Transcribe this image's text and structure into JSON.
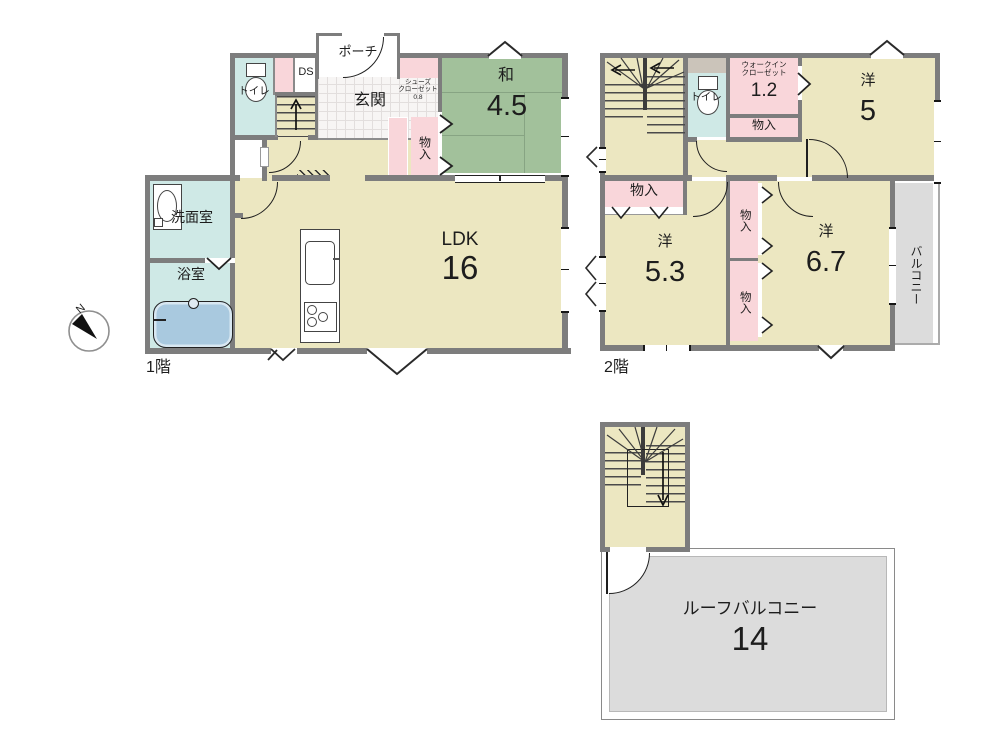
{
  "compass": {
    "north": "N"
  },
  "shared": {
    "storage": "物入",
    "toilet": "トイレ",
    "western": "洋"
  },
  "floor1": {
    "floor_label": "1階",
    "porch": "ポーチ",
    "entrance": "玄関",
    "ds": "DS",
    "shoes_closet_line1": "シューズ",
    "shoes_closet_line2": "クローゼット",
    "shoes_closet_line3": "0.8",
    "japanese_room": "和",
    "japanese_room_size": "4.5",
    "ldk": "LDK",
    "ldk_size": "16",
    "washroom": "洗面室",
    "bathroom": "浴室"
  },
  "floor2": {
    "floor_label": "2階",
    "wic_line1": "ウォークイン",
    "wic_line2": "クローゼット",
    "wic_size": "1.2",
    "western5_size": "5",
    "western53_size": "5.3",
    "western67_size": "6.7",
    "balcony": "バルコニー"
  },
  "roof": {
    "balcony": "ルーフバルコニー",
    "balcony_size": "14"
  },
  "colors": {
    "room_yellow": "#ece7c1",
    "tatami_green": "#a2c19b",
    "water_cyan": "#cfe9e6",
    "closet_pink": "#f9d6da",
    "balcony_gray": "#dcdcdc",
    "wall_gray": "#7d7d7d",
    "tub_blue": "#a9c9df"
  }
}
